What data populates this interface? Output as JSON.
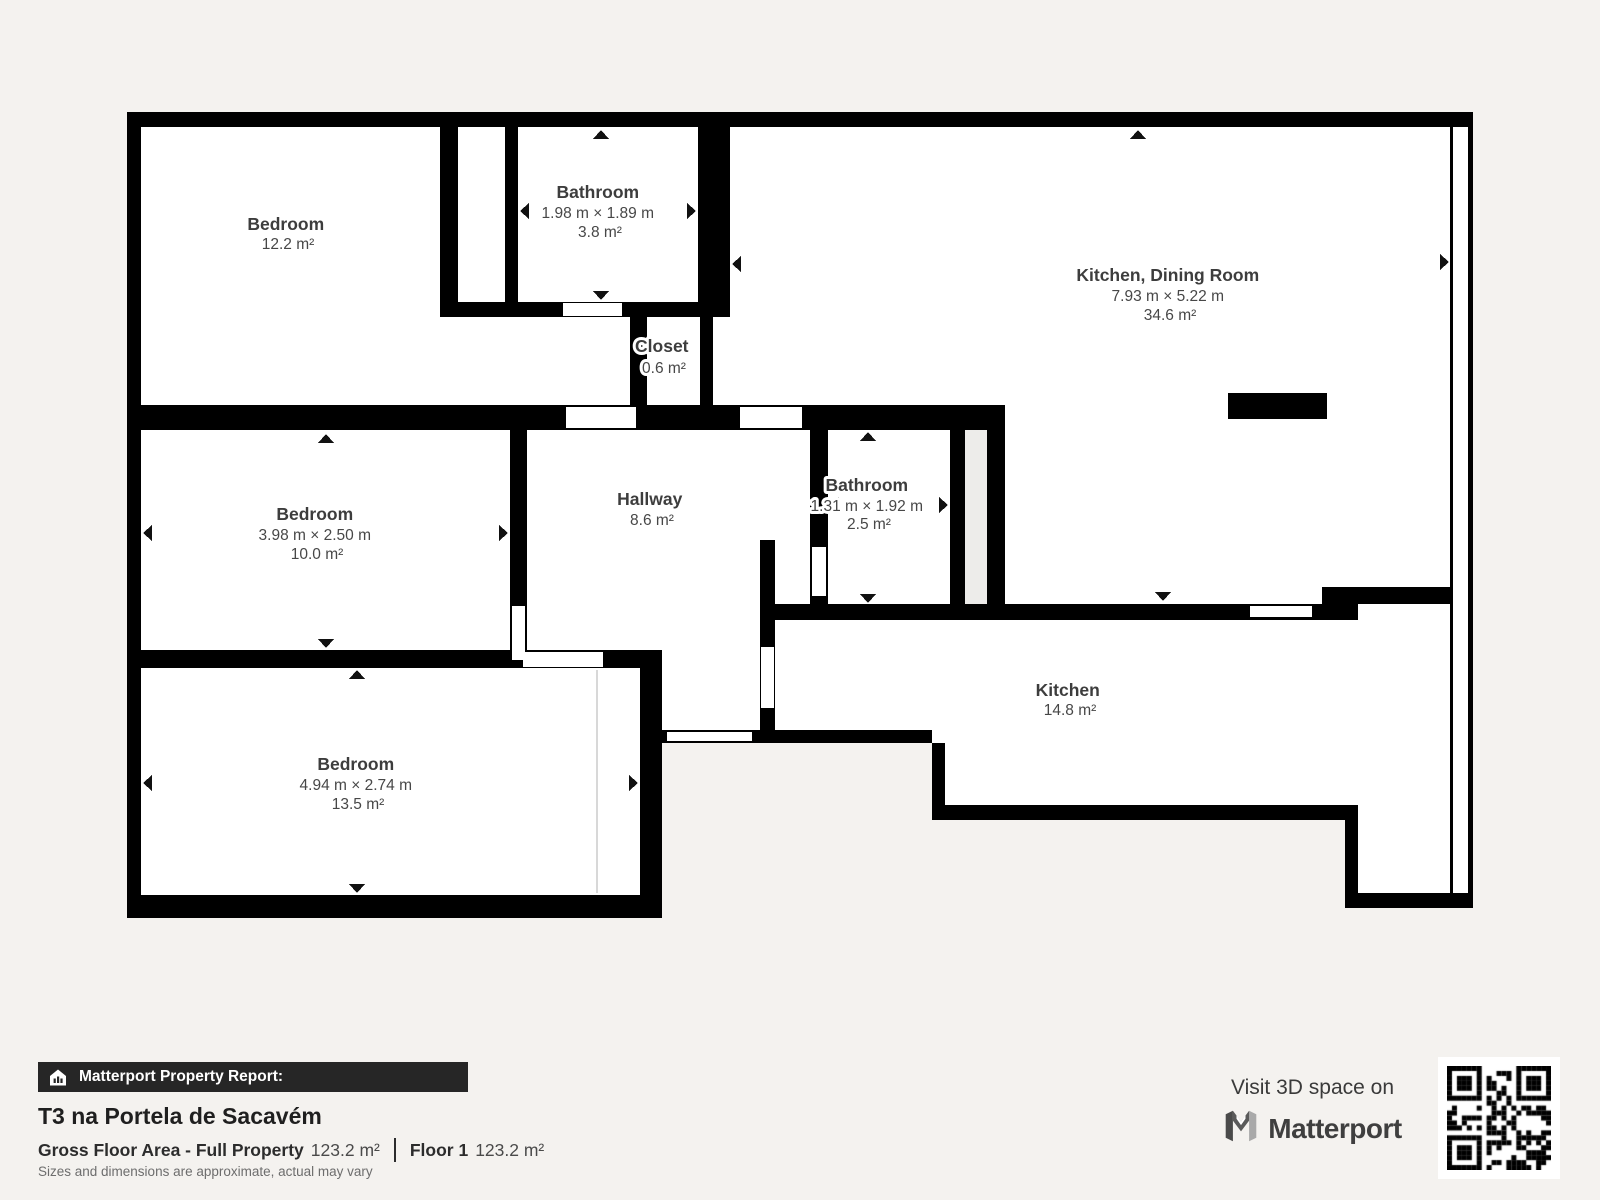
{
  "plan": {
    "rooms": [
      {
        "id": "bedroom-1",
        "name": "Bedroom",
        "dims": "",
        "area": "12.2 m²",
        "cx": 288,
        "cy": 230
      },
      {
        "id": "bathroom-1",
        "name": "Bathroom",
        "dims": "1.98 m × 1.89 m",
        "area": "3.8 m²",
        "cx": 600,
        "cy": 198
      },
      {
        "id": "closet",
        "name": "Closet",
        "dims": "",
        "area": "0.6 m²",
        "cx": 664,
        "cy": 352
      },
      {
        "id": "kitchen-dining",
        "name": "Kitchen, Dining Room",
        "dims": "7.93 m × 5.22 m",
        "area": "34.6 m²",
        "cx": 1170,
        "cy": 281
      },
      {
        "id": "bedroom-2",
        "name": "Bedroom",
        "dims": "3.98 m × 2.50 m",
        "area": "10.0 m²",
        "cx": 317,
        "cy": 520
      },
      {
        "id": "hallway",
        "name": "Hallway",
        "dims": "",
        "area": "8.6 m²",
        "cx": 652,
        "cy": 505
      },
      {
        "id": "bathroom-2",
        "name": "Bathroom",
        "dims": "1.31 m × 1.92 m",
        "area": "2.5 m²",
        "cx": 869,
        "cy": 491
      },
      {
        "id": "kitchen",
        "name": "Kitchen",
        "dims": "",
        "area": "14.8 m²",
        "cx": 1070,
        "cy": 696
      },
      {
        "id": "bedroom-3",
        "name": "Bedroom",
        "dims": "4.94 m × 2.74 m",
        "area": "13.5 m²",
        "cx": 358,
        "cy": 770
      }
    ]
  },
  "report": {
    "bar_label": "Matterport Property Report:",
    "title": "T3 na Portela de Sacavém",
    "gross_label": "Gross Floor Area - Full Property",
    "gross_value": "123.2 m²",
    "floor_label": "Floor 1",
    "floor_value": "123.2 m²",
    "disclaimer": "Sizes and dimensions are approximate, actual may vary"
  },
  "footer_right": {
    "visit_text": "Visit 3D space on",
    "brand": "Matterport"
  },
  "colors": {
    "background": "#f4f2ef",
    "wall": "#000000",
    "floor": "#ffffff",
    "bar_background": "#262626",
    "label_text": "#3d3d3d"
  }
}
